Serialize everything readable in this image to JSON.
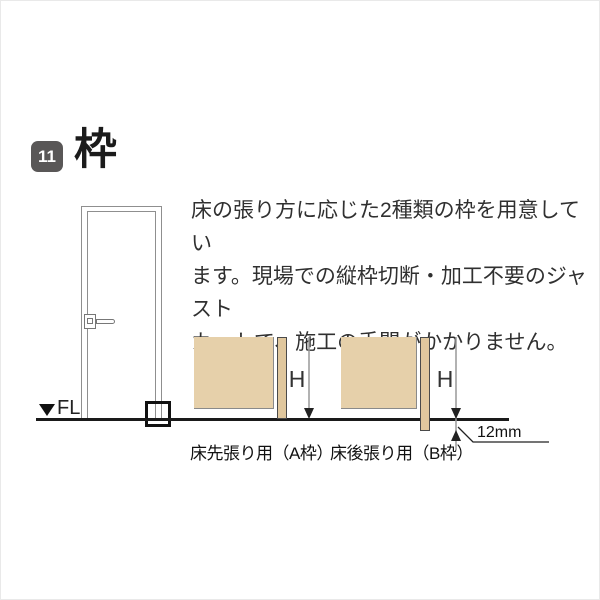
{
  "header": {
    "badge": "11",
    "title": "枠"
  },
  "description": {
    "text": "床の張り方に応じた2種類の枠を用意してい\nます。現場での縦枠切断・加工不要のジャスト\nカットで、施工の手間がかかりません。"
  },
  "floor_marker": {
    "label": "FL"
  },
  "diagram_a": {
    "caption": "床先張り用（A枠）",
    "height_label": "H"
  },
  "diagram_b": {
    "caption": "床後張り用（B枠）",
    "height_label": "H",
    "offset_label": "12mm"
  },
  "colors": {
    "badge_bg": "#595757",
    "badge_text": "#ffffff",
    "wall_fill": "#e6d0aa",
    "frame_fill": "#e0c79d",
    "frame_border": "#4a4a4a",
    "door_line": "#8f8f8f",
    "floor_line": "#1a1a1a",
    "dim_line": "#999999",
    "dim_dark": "#222222",
    "text_main": "#303030",
    "text_label": "#111111"
  }
}
